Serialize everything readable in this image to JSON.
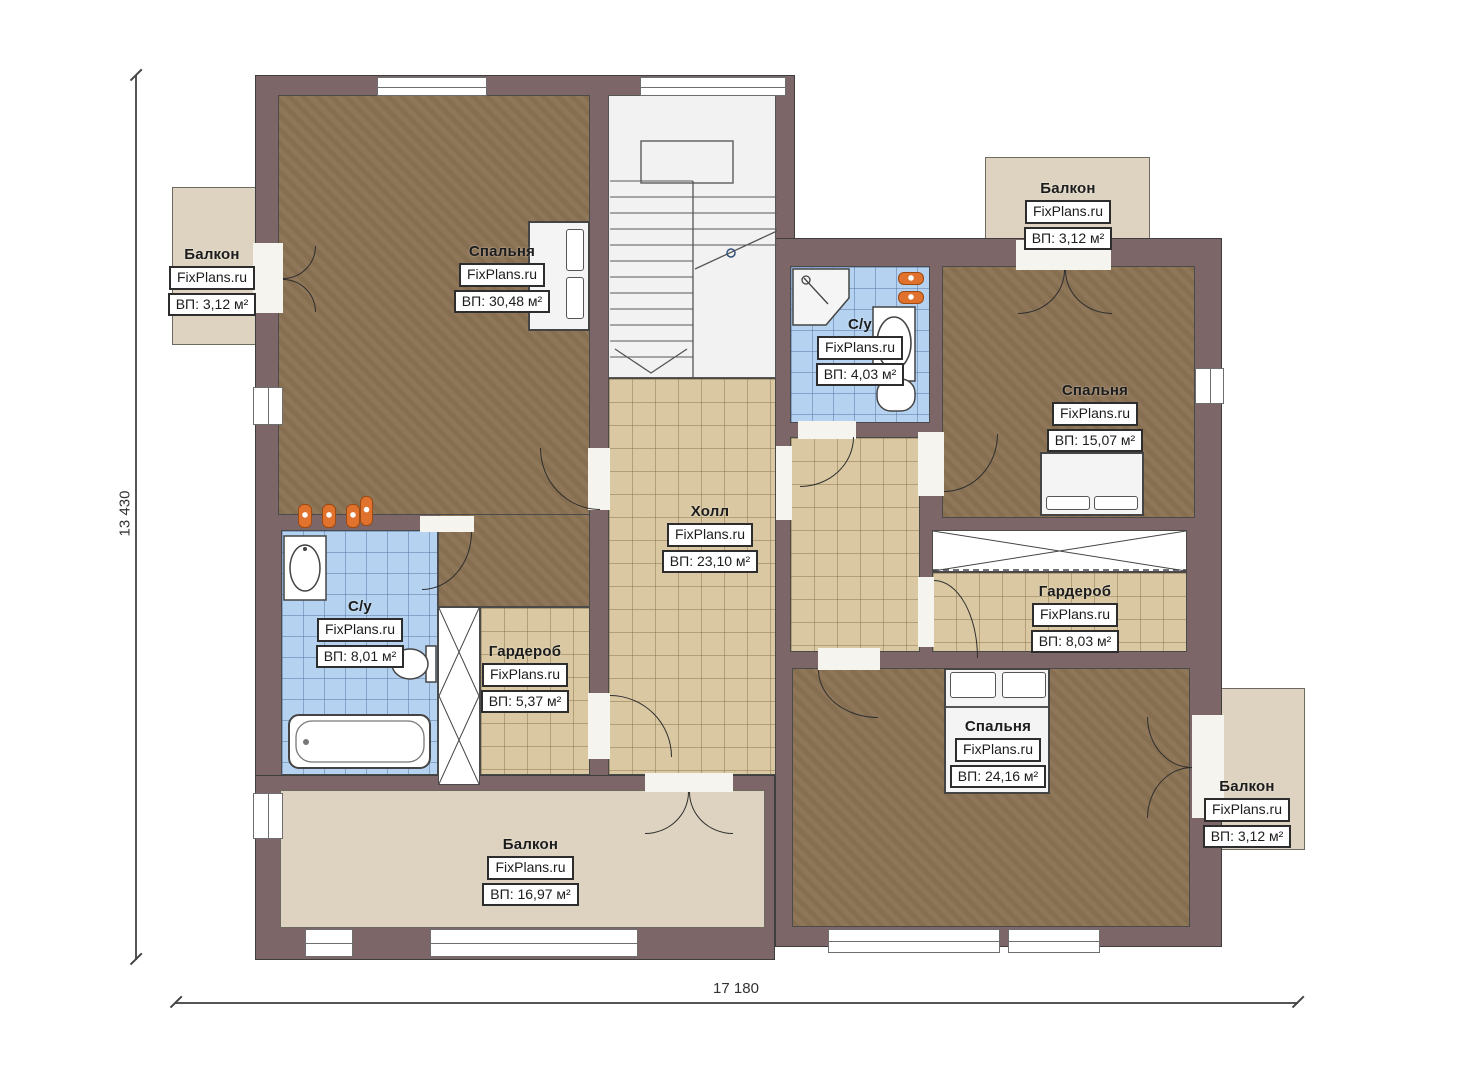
{
  "plan": {
    "brand_watermark": "FixPlans.ru",
    "dimension_width": "17 180",
    "dimension_height": "13 430",
    "rooms": [
      {
        "key": "bedroom-main",
        "name": "Спальня",
        "watermark": "FixPlans.ru",
        "area": "ВП: 30,48 м²"
      },
      {
        "key": "bathroom-top",
        "name": "С/у",
        "watermark": "FixPlans.ru",
        "area": "ВП: 4,03 м²"
      },
      {
        "key": "bedroom-right",
        "name": "Спальня",
        "watermark": "FixPlans.ru",
        "area": "ВП: 15,07 м²"
      },
      {
        "key": "hall",
        "name": "Холл",
        "watermark": "FixPlans.ru",
        "area": "ВП: 23,10 м²"
      },
      {
        "key": "bathroom-left",
        "name": "С/у",
        "watermark": "FixPlans.ru",
        "area": "ВП: 8,01 м²"
      },
      {
        "key": "wardrobe-small",
        "name": "Гардероб",
        "watermark": "FixPlans.ru",
        "area": "ВП: 5,37 м²"
      },
      {
        "key": "wardrobe-right",
        "name": "Гардероб",
        "watermark": "FixPlans.ru",
        "area": "ВП: 8,03 м²"
      },
      {
        "key": "bedroom-bottom",
        "name": "Спальня",
        "watermark": "FixPlans.ru",
        "area": "ВП: 24,16 м²"
      }
    ],
    "balconies": [
      {
        "key": "balcony-left",
        "name": "Балкон",
        "watermark": "FixPlans.ru",
        "area": "ВП: 3,12 м²"
      },
      {
        "key": "balcony-top-right",
        "name": "Балкон",
        "watermark": "FixPlans.ru",
        "area": "ВП: 3,12 м²"
      },
      {
        "key": "balcony-bottom",
        "name": "Балкон",
        "watermark": "FixPlans.ru",
        "area": "ВП: 16,97 м²"
      },
      {
        "key": "balcony-bottom-right",
        "name": "Балкон",
        "watermark": "FixPlans.ru",
        "area": "ВП: 3,12 м²"
      }
    ],
    "colors": {
      "wall": "#7c6667",
      "wood_floor": "#8b7254",
      "tile_blue": "#b5d3f0",
      "tile_tan": "#d9c8a2",
      "balcony": "#ded3c0",
      "heater_orange": "#e0722e"
    }
  }
}
